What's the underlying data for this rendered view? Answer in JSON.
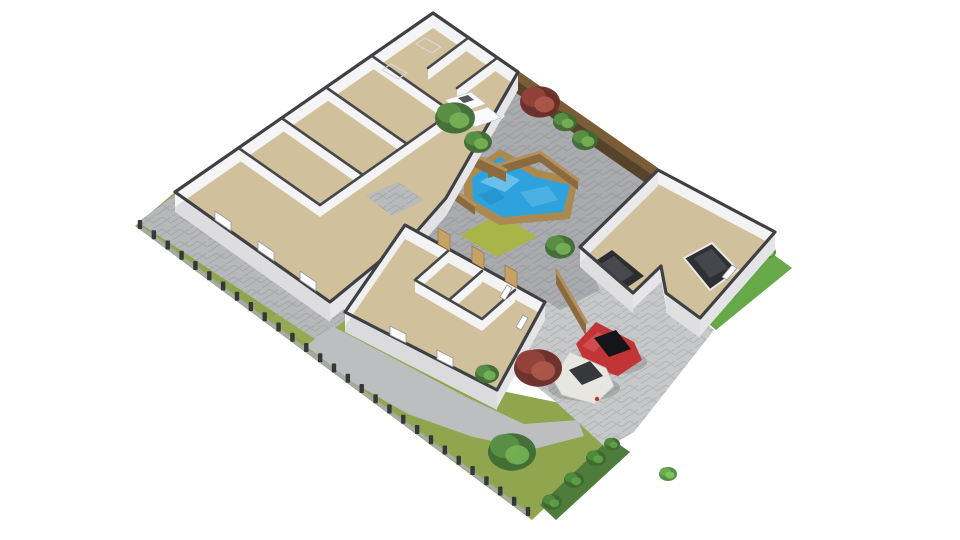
{
  "meta": {
    "kind": "3d-floorplan-render",
    "background": "#ffffff"
  },
  "palette": {
    "wall_cap": "#3f4044",
    "wall_face_light": "#f4f4f5",
    "wall_face_shade": "#e4e4e6",
    "floor_tan": "#d0c09b",
    "tile_gray": "#b8babc",
    "pool_blue": "#2ea2dc",
    "wood_top": "#b5905c",
    "wood_face": "#8a6a3e",
    "fence_dark": "#57432a",
    "lawn": "#90a64e",
    "court_pavers": "#a9abae",
    "driveway": "#c6c8ca",
    "path": "#bcbec0",
    "hedge_dark": "#4e7c3a",
    "hedge_bright": "#67a848",
    "car_red": "#c23537",
    "car_white": "#e8e6e0",
    "car_dark": "#2b2d30"
  },
  "tree_palettes": {
    "green": [
      "#3f6c34",
      "#5b9146",
      "#77b257"
    ],
    "red": [
      "#6b2d27",
      "#93433a",
      "#ae5a4b"
    ],
    "bush": [
      "#4c8a3a",
      "#6cae4e",
      "#85c563"
    ],
    "bushdark": [
      "#3d6b2f",
      "#4f8a3c",
      "#62a04a"
    ]
  },
  "scene": {
    "width": 960,
    "height": 540,
    "shapes": [
      {
        "n": "lawn",
        "t": "poly",
        "p": "175,192 345,310 497,390 560,403 614,442 532,520 135,226",
        "f": "#90a64e"
      },
      {
        "n": "lawn-highlight",
        "t": "poly",
        "p": "300,290 430,370 400,400 270,320",
        "f": "#9cb058",
        "o": 0.45
      },
      {
        "n": "hedge-bottom",
        "t": "poly",
        "p": "540,505 610,438 630,452 556,520",
        "f": "#4e7c3a"
      },
      {
        "n": "side-path",
        "t": "poly",
        "p": "176,194 352,315 318,341 138,222",
        "f": "#b6b8ba",
        "pat": true
      },
      {
        "n": "winding-path",
        "t": "poly",
        "p": "332,326 408,366 468,398 524,424 578,420 584,436 530,450 470,436 408,414 352,382 306,346",
        "f": "#bcbec0"
      },
      {
        "n": "boundary-fence-rail",
        "t": "line",
        "a": [
          140,
          227
        ],
        "b": [
          528,
          514
        ],
        "s": "#a6a8aa",
        "sw": 3.5
      },
      {
        "n": "boundary-fence-posts",
        "t": "posts",
        "a": [
          140,
          227
        ],
        "b": [
          528,
          514
        ],
        "num": 28,
        "f": "#35373a"
      },
      {
        "n": "driveway",
        "t": "poly",
        "p": "580,247 633,293 661,266 666,293 700,318 714,330 634,432 606,448 556,402 490,350 522,316 556,292",
        "f": "#c6c8ca",
        "pat": true
      },
      {
        "n": "hedge-right-strip",
        "t": "poly",
        "p": "762,246 792,268 716,330 688,306",
        "f": "#67a848"
      },
      {
        "n": "hedge-right-bush-1",
        "t": "tree",
        "c": [
          768,
          252
        ],
        "r": 8,
        "k": "bush"
      },
      {
        "n": "hedge-right-bush-2",
        "t": "tree",
        "c": [
          752,
          262
        ],
        "r": 11,
        "k": "bush"
      },
      {
        "n": "hedge-right-bush-3",
        "t": "tree",
        "c": [
          728,
          290
        ],
        "r": 11,
        "k": "bush"
      },
      {
        "n": "hedge-right-bush-4",
        "t": "tree",
        "c": [
          702,
          314
        ],
        "r": 10,
        "k": "bush"
      },
      {
        "n": "courtyard-pavers",
        "t": "poly",
        "p": "518,74 656,170 582,246 600,290 560,310 545,300 470,262 405,225 446,198 470,146 505,116 484,99",
        "f": "#a9abae",
        "pat": true
      },
      {
        "n": "courtyard-grass-patch",
        "t": "poly",
        "p": "500,213 537,237 497,257 460,235",
        "f": "#a9b548"
      },
      {
        "n": "pool-deck",
        "t": "poly",
        "p": "464,174 500,149 538,170 578,179 570,219 499,225 464,204",
        "f": "#ab8a52"
      },
      {
        "n": "pool-water",
        "t": "poly",
        "p": "472,178 500,157 535,177 570,185 563,212 502,217 473,200",
        "f": "#2ea2dc"
      },
      {
        "n": "pool-wave-1",
        "t": "poly",
        "p": "480,182 500,170 520,180 505,192",
        "f": "#79c8ee",
        "o": 0.8
      },
      {
        "n": "pool-wave-2",
        "t": "poly",
        "p": "520,192 548,186 558,200 532,207",
        "f": "#58b8e6",
        "o": 0.7
      },
      {
        "n": "pool-wave-3",
        "t": "poly",
        "p": "478,195 495,188 505,198 490,205",
        "f": "#1b89c4",
        "o": 0.5
      },
      {
        "n": "deck-fence-a",
        "t": "wood",
        "a": [
          488,
          168
        ],
        "b": [
          540,
          152
        ],
        "h": 10
      },
      {
        "n": "deck-fence-b",
        "t": "wood",
        "a": [
          540,
          152
        ],
        "b": [
          578,
          180
        ],
        "h": 10
      },
      {
        "n": "deck-fence-c",
        "t": "wood",
        "a": [
          440,
          180
        ],
        "b": [
          475,
          205
        ],
        "h": 10
      },
      {
        "n": "planter-box-1",
        "t": "wood",
        "a": [
          432,
          128
        ],
        "b": [
          470,
          153
        ],
        "h": 12
      },
      {
        "n": "planter-box-2",
        "t": "wood",
        "a": [
          470,
          153
        ],
        "b": [
          506,
          170
        ],
        "h": 12
      },
      {
        "n": "passage-fence",
        "t": "wood",
        "a": [
          556,
          270
        ],
        "b": [
          586,
          322
        ],
        "h": 14
      },
      {
        "n": "tall-fence-top",
        "t": "poly",
        "p": "517,70 658,168 654,176 513,78",
        "f": "#7a5c36"
      },
      {
        "n": "tall-fence-face",
        "t": "poly",
        "p": "513,78 654,176 650,186 509,88",
        "f": "#57432a"
      },
      {
        "n": "house-main-block",
        "t": "block",
        "cap": [
          [
            433,
            13
          ],
          [
            518,
            72
          ],
          [
            446,
            198
          ],
          [
            418,
            230
          ],
          [
            330,
            302
          ],
          [
            175,
            192
          ]
        ],
        "floor": "#d0c09b",
        "faces": [
          {
            "i": 0,
            "f": "#f3f3f4",
            "h": 15
          },
          {
            "i": 1,
            "f": "#e6e6e8",
            "h": 18
          },
          {
            "i": 2,
            "f": "#e2e2e4",
            "h": 18
          },
          {
            "i": 3,
            "f": "#e6e6e8",
            "h": 18
          },
          {
            "i": 4,
            "f": "#dddde0",
            "h": 20
          },
          {
            "i": 5,
            "f": "#f5f5f6",
            "h": 15
          }
        ]
      },
      {
        "n": "room-divider-1",
        "t": "wall",
        "a": [
          372,
          56
        ],
        "b": [
          452,
          112
        ]
      },
      {
        "n": "room-divider-2",
        "t": "wall",
        "a": [
          327,
          88
        ],
        "b": [
          407,
          144
        ]
      },
      {
        "n": "room-divider-3",
        "t": "wall",
        "a": [
          283,
          119
        ],
        "b": [
          363,
          175
        ]
      },
      {
        "n": "room-divider-4",
        "t": "wall",
        "a": [
          240,
          149
        ],
        "b": [
          320,
          205
        ]
      },
      {
        "n": "corridor-wall",
        "t": "wall",
        "a": [
          452,
          112
        ],
        "b": [
          320,
          205
        ]
      },
      {
        "n": "closet-wall-1",
        "t": "wall",
        "a": [
          468,
          38
        ],
        "b": [
          428,
          68
        ]
      },
      {
        "n": "closet-wall-2",
        "t": "wall",
        "a": [
          497,
          58
        ],
        "b": [
          457,
          88
        ]
      },
      {
        "n": "skylight-outline-1",
        "t": "poly",
        "p": "425,38 441,47 432,53 416,44",
        "f": "none",
        "s": "#d8d8da",
        "sw": 1.2
      },
      {
        "n": "skylight-outline-2",
        "t": "poly",
        "p": "391,64 407,73 398,79 382,70",
        "f": "none",
        "s": "#d8d8da",
        "sw": 1.2
      },
      {
        "n": "bathroom-tile-floor",
        "t": "poly",
        "p": "366,196 398,182 424,200 392,216",
        "f": "#b8babc",
        "pat": true
      },
      {
        "n": "kitchen-island-1",
        "t": "poly",
        "p": "445,100 471,92 486,104 460,113",
        "f": "#fbfbfc",
        "s": "#c6c6c9",
        "sw": 0.8
      },
      {
        "n": "kitchen-island-2",
        "t": "poly",
        "p": "462,115 488,107 501,118 475,127",
        "f": "#fbfbfc",
        "s": "#c6c6c9",
        "sw": 0.8
      },
      {
        "n": "kitchen-cooktop",
        "t": "poly",
        "p": "458,98 468,95 474,100 464,103",
        "f": "#55565a"
      },
      {
        "n": "bedroom-wing-block",
        "t": "block",
        "cap": [
          [
            405,
            225
          ],
          [
            545,
            302
          ],
          [
            497,
            390
          ],
          [
            345,
            312
          ]
        ],
        "floor": "#d0c09b",
        "faces": [
          {
            "i": 0,
            "f": "#f3f3f4",
            "h": 14
          },
          {
            "i": 1,
            "f": "#e4e4e6",
            "h": 18
          },
          {
            "i": 2,
            "f": "#dbdbde",
            "h": 20
          },
          {
            "i": 3,
            "f": "#f0f0f1",
            "h": 14
          }
        ]
      },
      {
        "n": "wing-divider-1",
        "t": "wall",
        "a": [
          448,
          251
        ],
        "b": [
          415,
          280
        ]
      },
      {
        "n": "wing-divider-2",
        "t": "wall",
        "a": [
          482,
          271
        ],
        "b": [
          449,
          300
        ]
      },
      {
        "n": "wing-divider-3",
        "t": "wall",
        "a": [
          515,
          290
        ],
        "b": [
          482,
          319
        ]
      },
      {
        "n": "wing-corridor-wall",
        "t": "wall",
        "a": [
          415,
          280
        ],
        "b": [
          482,
          319
        ]
      },
      {
        "n": "door-panel-1",
        "t": "poly",
        "p": "438,244 450,251 450,235 438,228",
        "f": "#c8a264",
        "s": "#8a6a3e",
        "sw": 0.6
      },
      {
        "n": "door-panel-2",
        "t": "poly",
        "p": "472,262 484,269 484,253 472,246",
        "f": "#c8a264",
        "s": "#8a6a3e",
        "sw": 0.6
      },
      {
        "n": "door-panel-3",
        "t": "poly",
        "p": "505,281 517,288 517,272 505,265",
        "f": "#c8a264",
        "s": "#8a6a3e",
        "sw": 0.6
      },
      {
        "n": "window-west-1",
        "t": "poly",
        "p": "215,220 231,231 231,222 215,211",
        "f": "#fdfdfe",
        "s": "#98989c",
        "sw": 0.8
      },
      {
        "n": "window-west-2",
        "t": "poly",
        "p": "258,250 274,261 274,252 258,241",
        "f": "#fdfdfe",
        "s": "#98989c",
        "sw": 0.8
      },
      {
        "n": "window-west-3",
        "t": "poly",
        "p": "300,280 316,291 316,282 300,271",
        "f": "#fdfdfe",
        "s": "#98989c",
        "sw": 0.8
      },
      {
        "n": "window-wing-1",
        "t": "poly",
        "p": "390,335 406,343 406,334 390,326",
        "f": "#fdfdfe",
        "s": "#98989c",
        "sw": 0.8
      },
      {
        "n": "window-wing-2",
        "t": "poly",
        "p": "437,359 453,367 453,358 437,350",
        "f": "#fdfdfe",
        "s": "#98989c",
        "sw": 0.8
      },
      {
        "n": "window-wing-se-1",
        "t": "poly",
        "p": "512,288 505,300 500,297 507,285",
        "f": "#fdfdfe",
        "s": "#98989c",
        "sw": 0.8
      },
      {
        "n": "window-wing-se-2",
        "t": "poly",
        "p": "528,318 521,330 516,327 523,315",
        "f": "#fdfdfe",
        "s": "#98989c",
        "sw": 0.8
      },
      {
        "n": "garage-floor",
        "t": "poly",
        "p": "658,170 775,232 700,318 666,293 661,266 633,293 580,247",
        "f": "#d0c09b"
      },
      {
        "n": "garage-car-left-body",
        "t": "poly",
        "p": "588,266 612,250 644,276 620,292",
        "f": "#2b2d30"
      },
      {
        "n": "garage-car-left-roof",
        "t": "poly",
        "p": "598,266 614,256 634,274 618,284",
        "f": "#47494e"
      },
      {
        "n": "garage-car-right-body",
        "t": "poly",
        "p": "684,258 712,243 738,270 710,290",
        "f": "#2e3033",
        "s": "#e8e8e8",
        "sw": 2
      },
      {
        "n": "garage-car-right-roof",
        "t": "poly",
        "p": "694,258 712,249 728,268 710,278",
        "f": "#45474c"
      },
      {
        "n": "garage-walls",
        "t": "block",
        "cap": [
          [
            658,
            170
          ],
          [
            775,
            232
          ],
          [
            700,
            318
          ],
          [
            666,
            293
          ],
          [
            661,
            266
          ],
          [
            633,
            293
          ],
          [
            580,
            247
          ]
        ],
        "floor": "none",
        "faces": [
          {
            "i": 0,
            "f": "#f3f3f4",
            "h": 14
          },
          {
            "i": 1,
            "f": "#e4e4e6",
            "h": 18
          },
          {
            "i": 2,
            "f": "#dfdfe2",
            "h": 20
          },
          {
            "i": 3,
            "f": "#e8e8ea",
            "h": 14
          },
          {
            "i": 4,
            "f": "#e6e6e8",
            "h": 16
          },
          {
            "i": 5,
            "f": "#dfdfe2",
            "h": 20
          },
          {
            "i": 6,
            "f": "#e9e9eb",
            "h": 16
          }
        ]
      },
      {
        "n": "window-garage",
        "t": "poly",
        "p": "737,268 727,280 722,277 732,265",
        "f": "#fdfdfe",
        "s": "#98989c",
        "sw": 0.8
      },
      {
        "n": "red-car-shadow",
        "t": "ell",
        "c": [
          610,
          362
        ],
        "rx": 37,
        "ry": 13,
        "f": "#000000",
        "o": 0.14
      },
      {
        "n": "red-car-body",
        "t": "poly",
        "p": "576,344 596,322 634,342 642,360 618,376 586,364",
        "f": "#c23537"
      },
      {
        "n": "red-car-hood-highlight",
        "t": "poly",
        "p": "582,346 598,332 608,338 594,352",
        "f": "#d9595b",
        "o": 0.65
      },
      {
        "n": "red-car-cabin",
        "t": "poly",
        "p": "594,338 616,330 631,349 609,357",
        "f": "#141518"
      },
      {
        "n": "white-van-shadow",
        "t": "ell",
        "c": [
          584,
          388
        ],
        "rx": 36,
        "ry": 13,
        "f": "#000000",
        "o": 0.14
      },
      {
        "n": "white-van-body",
        "t": "poly",
        "p": "552,378 570,352 606,368 614,386 595,404 562,395",
        "f": "#e8e6e0",
        "s": "#c9c7c0",
        "sw": 0.8
      },
      {
        "n": "white-van-roof",
        "t": "poly",
        "p": "569,370 590,361 603,376 582,385",
        "f": "#37383c"
      },
      {
        "n": "white-van-taillight",
        "t": "ell",
        "c": [
          597,
          399
        ],
        "rx": 2.2,
        "ry": 2.2,
        "f": "#c0392b",
        "o": 1
      },
      {
        "n": "tree-planter-1",
        "t": "tree",
        "c": [
          455,
          118
        ],
        "r": 20,
        "k": "green"
      },
      {
        "n": "tree-planter-2",
        "t": "tree",
        "c": [
          478,
          142
        ],
        "r": 14,
        "k": "green"
      },
      {
        "n": "tree-fence-vine-red",
        "t": "tree",
        "c": [
          540,
          102
        ],
        "r": 20,
        "k": "red"
      },
      {
        "n": "tree-fence-green-1",
        "t": "tree",
        "c": [
          565,
          122
        ],
        "r": 12,
        "k": "green"
      },
      {
        "n": "tree-fence-green-2",
        "t": "tree",
        "c": [
          585,
          140
        ],
        "r": 13,
        "k": "green"
      },
      {
        "n": "tree-courtyard-green",
        "t": "tree",
        "c": [
          560,
          247
        ],
        "r": 15,
        "k": "green"
      },
      {
        "n": "tree-lawn-red",
        "t": "tree",
        "c": [
          538,
          368
        ],
        "r": 24,
        "k": "red"
      },
      {
        "n": "tree-lawn-green-large",
        "t": "tree",
        "c": [
          512,
          452
        ],
        "r": 24,
        "k": "green"
      },
      {
        "n": "tree-lawn-green-small",
        "t": "tree",
        "c": [
          487,
          374
        ],
        "r": 12,
        "k": "green"
      },
      {
        "n": "bush-corner",
        "t": "tree",
        "c": [
          668,
          474
        ],
        "r": 9,
        "k": "bush"
      },
      {
        "n": "hedge-bottom-bush-1",
        "t": "tree",
        "c": [
          552,
          502
        ],
        "r": 10,
        "k": "bushdark"
      },
      {
        "n": "hedge-bottom-bush-2",
        "t": "tree",
        "c": [
          574,
          480
        ],
        "r": 10,
        "k": "bushdark"
      },
      {
        "n": "hedge-bottom-bush-3",
        "t": "tree",
        "c": [
          596,
          458
        ],
        "r": 10,
        "k": "bushdark"
      },
      {
        "n": "hedge-bottom-bush-4",
        "t": "tree",
        "c": [
          612,
          444
        ],
        "r": 8,
        "k": "bushdark"
      }
    ]
  }
}
